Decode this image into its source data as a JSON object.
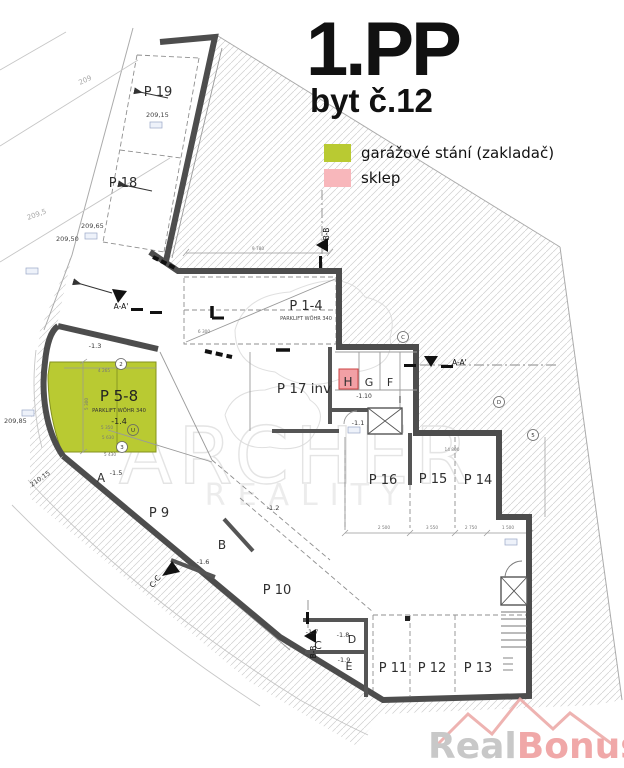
{
  "title": {
    "floor": "1.PP",
    "unit": "byt č.12"
  },
  "legend": {
    "items": [
      {
        "label": "garážové stání (zakladač)",
        "color": "#b9ca32"
      },
      {
        "label": "sklep",
        "color": "#f8b7bb"
      }
    ]
  },
  "watermark": {
    "line1": "ARCHER",
    "line2": "REALITY"
  },
  "logo": {
    "part1": "Real",
    "part2": "Bonus",
    "part3": ".cz",
    "gray": "#c8c8c8",
    "accent": "#e89a96"
  },
  "plan": {
    "stalls": [
      "P 19",
      "P 18",
      "P 1-4",
      "P 17 inv",
      "P 16",
      "P 15",
      "P 14",
      "P 9",
      "P 10",
      "P 11",
      "P 12",
      "P 13"
    ],
    "stall_system": "PARKLIFT WÖHR 340",
    "highlight": {
      "label": "P 5-8",
      "system": "PARKLIFT WÖHR 340",
      "level": "-1.4"
    },
    "cells": [
      "A",
      "B",
      "C",
      "D",
      "E",
      "F",
      "G",
      "H",
      "I"
    ],
    "elevations": [
      "-1.1",
      "-1.2",
      "-1.3",
      "-1.5",
      "-1.6",
      "-1.7",
      "-1.8",
      "-1.9",
      "-1.10"
    ],
    "terrain": [
      "209",
      "209,5",
      "209,50",
      "209,15",
      "209,65",
      "209,85",
      "210,15"
    ],
    "sections": [
      "A-A'",
      "A-A'",
      "B-B",
      "B-B",
      "C-C"
    ],
    "dims": [
      "9 780",
      "4 265",
      "5 300",
      "5 350",
      "5 630",
      "5 430",
      "6 300",
      "14 800",
      "2 500",
      "3 550",
      "2 750",
      "1 500"
    ],
    "refs": [
      "2",
      "3",
      "U",
      "C",
      "D",
      "5"
    ]
  }
}
